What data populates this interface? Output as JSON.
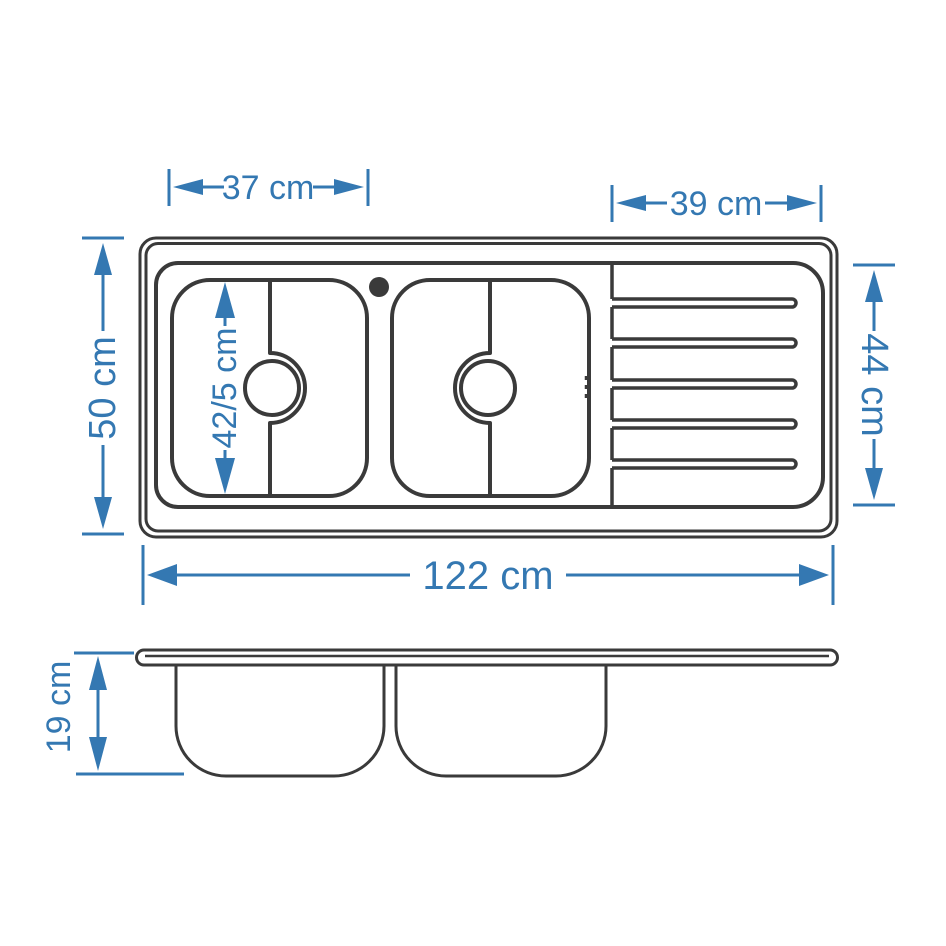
{
  "document": {
    "type": "technical-drawing",
    "subject": "double-bowl kitchen sink with drainboard, plan view and side elevation"
  },
  "colors": {
    "line": "#3a3a3a",
    "dimension": "#3478b2",
    "background": "#ffffff"
  },
  "dimensions": {
    "left_bowl_width": "37 cm",
    "drainboard_width": "39 cm",
    "total_depth": "50 cm",
    "bowl_inner_depth": "42/5 cm",
    "drainboard_depth": "44 cm",
    "total_length": "122 cm",
    "profile_height": "19 cm"
  }
}
